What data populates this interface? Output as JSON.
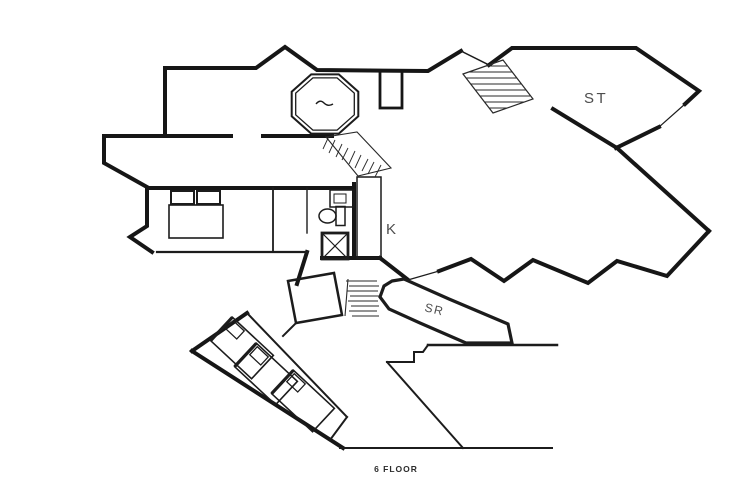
{
  "floor_plan": {
    "caption": "6 FLOOR",
    "rooms": [
      {
        "id": "stairs-room",
        "label": "ST"
      },
      {
        "id": "kitchen",
        "label": "K"
      },
      {
        "id": "storage-room",
        "label": "SR"
      }
    ],
    "fixtures": [
      "octagonal-spa",
      "upper-staircase",
      "side-staircase",
      "winder-staircase",
      "double-bed",
      "bunk-bed-1",
      "bunk-bed-2",
      "bunk-bed-3",
      "toilet",
      "sink-vanity",
      "shower",
      "closet"
    ],
    "colors": {
      "background": "#ffffff",
      "walls": "#161616",
      "room_labels": "#4d4d4d",
      "caption": "#2b2b2b"
    }
  }
}
